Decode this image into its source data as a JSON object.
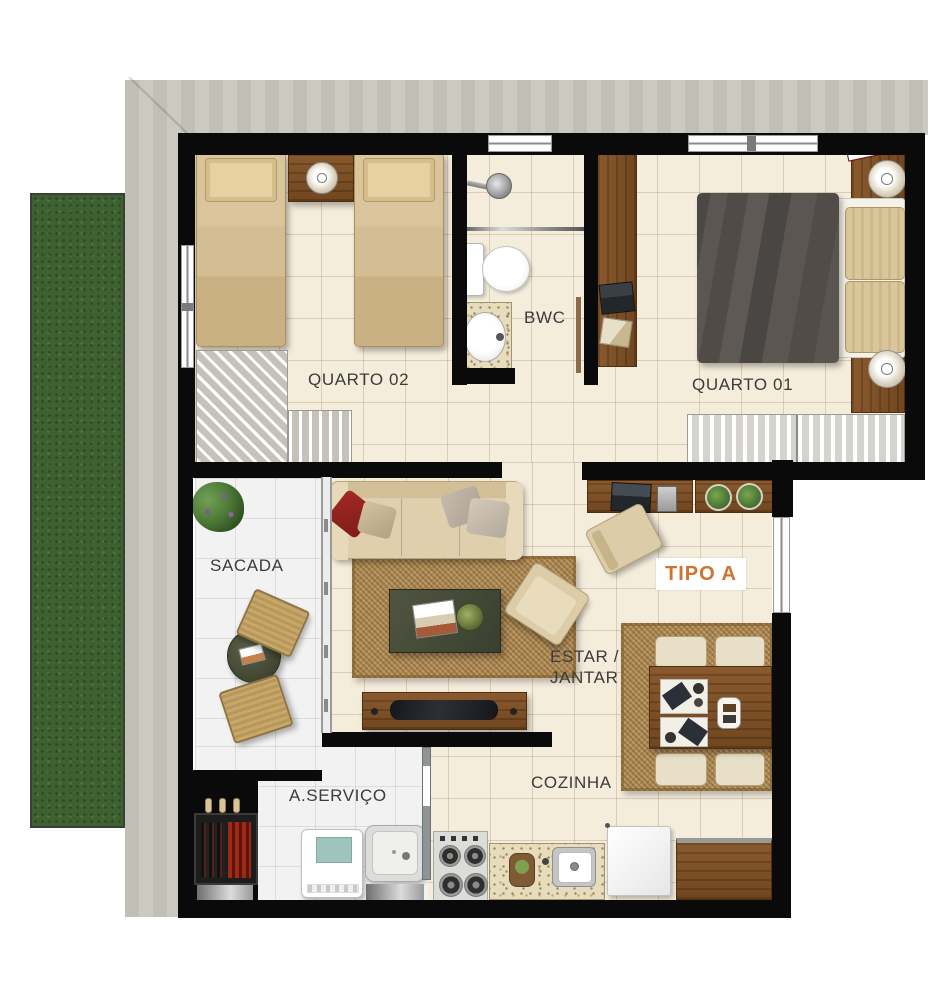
{
  "plan": {
    "type": "apartment-floor-plan",
    "unit_label": "TIPO A",
    "labels": {
      "quarto02": "QUARTO 02",
      "bwc": "BWC",
      "quarto01": "QUARTO 01",
      "sacada": "SACADA",
      "estar_line1": "ESTAR /",
      "estar_line2": "JANTAR",
      "cozinha": "COZINHA",
      "servico": "A.SERVIÇO"
    },
    "colors": {
      "accent_orange": "#D2722F",
      "wall_black": "#0A0A0A",
      "floor_tile_cream": "#F5EDDC",
      "floor_tile_white": "#F2F2F2",
      "grass_green": "#3E6130",
      "concrete_gray": "#C9C6BE",
      "wood_brown": "#7A4E27",
      "sofa_beige": "#DFCFAC",
      "rug_sisal": "#B08A55",
      "pillow_red": "#8E1F1C",
      "blanket_gray": "#57534E"
    },
    "rooms": [
      {
        "name": "quarto-02",
        "label": "QUARTO 02",
        "furniture": [
          "single-bed",
          "single-bed",
          "nightstand",
          "table-lamp",
          "corner-wardrobe"
        ]
      },
      {
        "name": "bwc",
        "label": "BWC",
        "furniture": [
          "shower",
          "glass-partition",
          "toilet",
          "sink-counter"
        ]
      },
      {
        "name": "quarto-01",
        "label": "QUARTO 01",
        "furniture": [
          "double-bed",
          "headboard-nightstands",
          "table-lamp",
          "table-lamp",
          "desk",
          "laptop",
          "wardrobe"
        ]
      },
      {
        "name": "sacada",
        "label": "SACADA",
        "furniture": [
          "plant",
          "round-table",
          "wicker-chair",
          "wicker-chair"
        ]
      },
      {
        "name": "estar-jantar",
        "label": "ESTAR / JANTAR",
        "furniture": [
          "sofa",
          "throw-pillows",
          "rug",
          "coffee-table",
          "armchair",
          "tv-rack",
          "tv",
          "desk",
          "desk-chair",
          "plant-shelf",
          "dining-rug",
          "dining-table",
          "dining-chairs"
        ]
      },
      {
        "name": "cozinha",
        "label": "COZINHA",
        "furniture": [
          "stove",
          "granite-counter",
          "sink",
          "refrigerator",
          "wood-counter"
        ]
      },
      {
        "name": "a-servico",
        "label": "A.SERVIÇO",
        "furniture": [
          "washing-machine",
          "laundry-sink",
          "barbecue-grill"
        ]
      }
    ]
  }
}
